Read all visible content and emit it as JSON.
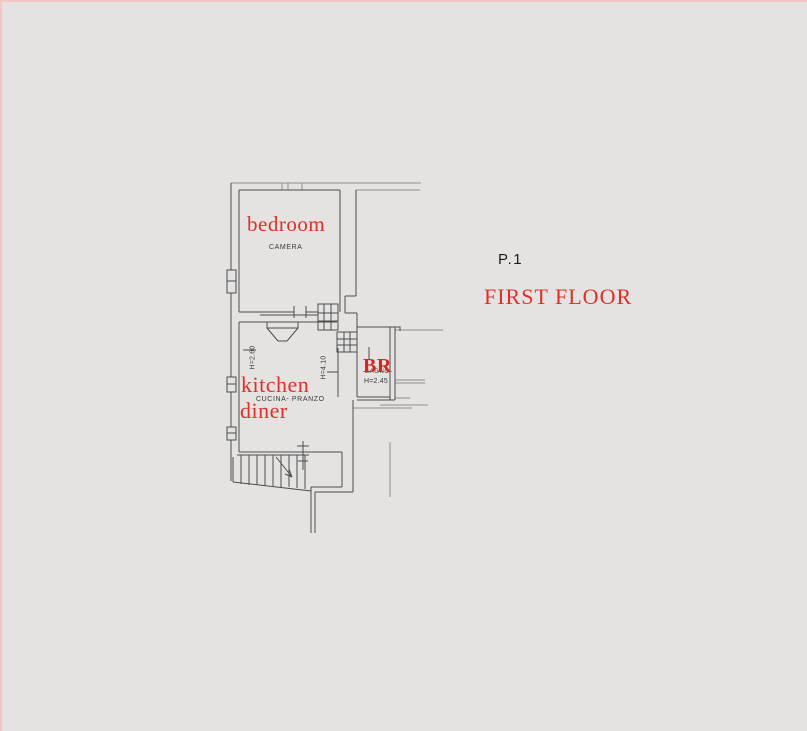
{
  "canvas": {
    "background_color": "#e4e3e2",
    "frame_color": "#f4c6c4"
  },
  "colors": {
    "accent_red": "#e02f28",
    "line_dark": "#4d4d4d",
    "line_light": "#8f8f8f",
    "text_dark": "#3a3a3a"
  },
  "plan": {
    "rooms": {
      "bedroom": {
        "label": "bedroom",
        "native_label": "CAMERA"
      },
      "kitchen": {
        "label_line1": "kitchen",
        "label_line2": "diner",
        "native_label": "CUCINA- PRANZO",
        "ceiling_height_left": "H=2.60",
        "ceiling_height_right": "H=4.10"
      },
      "bathroom": {
        "label": "BR",
        "native_label": "BAGNO",
        "ceiling_height": "H=2.45"
      }
    }
  },
  "titles": {
    "floor_code": "P.1",
    "floor_name": "FIRST FLOOR"
  }
}
